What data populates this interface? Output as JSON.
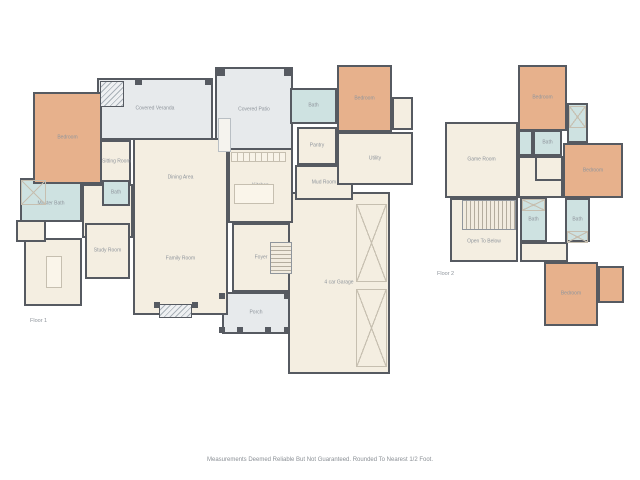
{
  "page": {
    "background": "#ffffff",
    "disclaimer": "Measurements Deemed Reliable But Not Guaranteed. Rounded To Nearest 1/2 Foot."
  },
  "palette": {
    "wall": "#565a61",
    "room_fill": "#f4eee1",
    "bedroom_fill": "#e7b18c",
    "bath_fill": "#cee2e1",
    "outdoor_fill": "#e7eaec",
    "label_text": "#8f959c",
    "fixture_line": "#c6bfb0"
  },
  "floors": [
    {
      "id": "floor-1",
      "label": "Floor 1",
      "label_pos": {
        "x": 30,
        "y": 318
      },
      "rooms": [
        {
          "name": "covered-veranda",
          "label": "Covered Veranda",
          "type": "outdoor",
          "x": 97,
          "y": 78,
          "w": 116,
          "h": 62
        },
        {
          "name": "covered-patio",
          "label": "Covered Patio",
          "type": "outdoor",
          "x": 215,
          "y": 67,
          "w": 78,
          "h": 85
        },
        {
          "name": "porch",
          "label": "Porch",
          "type": "outdoor",
          "x": 222,
          "y": 292,
          "w": 68,
          "h": 42
        },
        {
          "name": "garage",
          "label": "4 car Garage",
          "type": "room",
          "x": 288,
          "y": 192,
          "w": 102,
          "h": 182
        },
        {
          "name": "great-room",
          "type": "room",
          "x": 133,
          "y": 138,
          "w": 95,
          "h": 177,
          "labels": [
            {
              "text": "Dining Area",
              "top": 22
            },
            {
              "text": "Family Room",
              "top": 69
            }
          ]
        },
        {
          "name": "kitchen",
          "label": "Kitchen",
          "type": "room",
          "x": 228,
          "y": 148,
          "w": 65,
          "h": 75
        },
        {
          "name": "pantry",
          "label": "Pantry",
          "type": "room",
          "x": 297,
          "y": 127,
          "w": 40,
          "h": 38
        },
        {
          "name": "mud-room",
          "label": "Mud Room",
          "type": "room",
          "x": 295,
          "y": 165,
          "w": 58,
          "h": 35
        },
        {
          "name": "utility",
          "label": "Utility",
          "type": "room",
          "x": 337,
          "y": 132,
          "w": 76,
          "h": 53
        },
        {
          "name": "bedroom-closet",
          "type": "room",
          "x": 392,
          "y": 97,
          "w": 21,
          "h": 33
        },
        {
          "name": "foyer",
          "label": "Foyer",
          "type": "room",
          "x": 232,
          "y": 223,
          "w": 58,
          "h": 69
        },
        {
          "name": "hall",
          "type": "room",
          "x": 82,
          "y": 184,
          "w": 51,
          "h": 54
        },
        {
          "name": "study-room",
          "label": "Study Room",
          "type": "room",
          "x": 85,
          "y": 223,
          "w": 45,
          "h": 56
        },
        {
          "name": "hobby-room",
          "type": "room",
          "x": 24,
          "y": 238,
          "w": 58,
          "h": 68
        },
        {
          "name": "water-closet",
          "type": "room",
          "x": 16,
          "y": 220,
          "w": 30,
          "h": 22
        },
        {
          "name": "sitting-room",
          "label": "Sitting Room",
          "type": "room",
          "x": 100,
          "y": 140,
          "w": 31,
          "h": 44
        },
        {
          "name": "bath-hall",
          "label": "Bath",
          "type": "bath",
          "x": 102,
          "y": 180,
          "w": 28,
          "h": 26
        },
        {
          "name": "master-bath",
          "type": "bath",
          "x": 20,
          "y": 178,
          "w": 62,
          "h": 44,
          "labels": [
            {
              "text": "Master Bath",
              "top": 60
            }
          ]
        },
        {
          "name": "bath-guest",
          "label": "Bath",
          "type": "bath",
          "x": 290,
          "y": 88,
          "w": 47,
          "h": 36
        },
        {
          "name": "bedroom-master",
          "label": "Bedroom",
          "type": "bedroom",
          "x": 33,
          "y": 92,
          "w": 69,
          "h": 92
        },
        {
          "name": "bedroom-guest",
          "label": "Bedroom",
          "type": "bedroom",
          "x": 337,
          "y": 65,
          "w": 55,
          "h": 67
        }
      ],
      "features": [
        {
          "name": "veranda-fireplace",
          "type": "hatch",
          "x": 100,
          "y": 81,
          "w": 24,
          "h": 26
        },
        {
          "name": "veranda-post",
          "type": "post",
          "x": 135,
          "y": 78,
          "w": 7,
          "h": 7
        },
        {
          "name": "veranda-post",
          "type": "post",
          "x": 205,
          "y": 78,
          "w": 7,
          "h": 7
        },
        {
          "name": "patio-post",
          "type": "post",
          "x": 216,
          "y": 67,
          "w": 9,
          "h": 9
        },
        {
          "name": "patio-post",
          "type": "post",
          "x": 284,
          "y": 67,
          "w": 9,
          "h": 9
        },
        {
          "name": "outdoor-kitchen",
          "type": "appliance",
          "x": 218,
          "y": 118,
          "w": 13,
          "h": 34
        },
        {
          "name": "kitchen-counter",
          "type": "counter",
          "x": 231,
          "y": 152,
          "w": 55,
          "h": 10
        },
        {
          "name": "kitchen-island",
          "type": "island",
          "x": 234,
          "y": 184,
          "w": 40,
          "h": 20
        },
        {
          "name": "hobby-island",
          "type": "island",
          "x": 46,
          "y": 256,
          "w": 16,
          "h": 32
        },
        {
          "name": "master-shower",
          "type": "xbox",
          "x": 21,
          "y": 180,
          "w": 25,
          "h": 25
        },
        {
          "name": "foyer-stairs",
          "type": "stairs",
          "x": 270,
          "y": 242,
          "w": 22,
          "h": 32
        },
        {
          "name": "garage-door",
          "type": "xbox",
          "x": 356,
          "y": 204,
          "w": 31,
          "h": 78
        },
        {
          "name": "garage-door",
          "type": "xbox",
          "x": 356,
          "y": 289,
          "w": 31,
          "h": 78
        },
        {
          "name": "family-fireplace",
          "type": "hatch",
          "x": 159,
          "y": 304,
          "w": 33,
          "h": 14
        },
        {
          "name": "fireplace-post",
          "type": "post",
          "x": 154,
          "y": 302,
          "w": 6,
          "h": 6
        },
        {
          "name": "fireplace-post",
          "type": "post",
          "x": 192,
          "y": 302,
          "w": 6,
          "h": 6
        },
        {
          "name": "porch-post",
          "type": "post",
          "x": 219,
          "y": 293,
          "w": 6,
          "h": 6
        },
        {
          "name": "porch-post",
          "type": "post",
          "x": 284,
          "y": 293,
          "w": 6,
          "h": 6
        },
        {
          "name": "porch-post",
          "type": "post",
          "x": 219,
          "y": 327,
          "w": 6,
          "h": 6
        },
        {
          "name": "porch-post",
          "type": "post",
          "x": 237,
          "y": 327,
          "w": 6,
          "h": 6
        },
        {
          "name": "porch-post",
          "type": "post",
          "x": 265,
          "y": 327,
          "w": 6,
          "h": 6
        },
        {
          "name": "porch-post",
          "type": "post",
          "x": 284,
          "y": 327,
          "w": 6,
          "h": 6
        }
      ]
    },
    {
      "id": "floor-2",
      "label": "Floor 2",
      "label_pos": {
        "x": 437,
        "y": 271
      },
      "rooms": [
        {
          "name": "game-room",
          "label": "Game Room",
          "type": "room",
          "x": 445,
          "y": 122,
          "w": 73,
          "h": 76
        },
        {
          "name": "open-to-below",
          "type": "room",
          "x": 450,
          "y": 198,
          "w": 68,
          "h": 64,
          "labels": [
            {
              "text": "Open To Below",
              "top": 70
            }
          ]
        },
        {
          "name": "hall-upper",
          "type": "room",
          "x": 518,
          "y": 156,
          "w": 45,
          "h": 42
        },
        {
          "name": "linen-hall",
          "type": "room",
          "x": 535,
          "y": 156,
          "w": 28,
          "h": 25
        },
        {
          "name": "corridor",
          "type": "room",
          "x": 520,
          "y": 242,
          "w": 48,
          "h": 20
        },
        {
          "name": "toilet-cell",
          "type": "bath",
          "x": 518,
          "y": 130,
          "w": 15,
          "h": 26
        },
        {
          "name": "bath-jack",
          "label": "Bath",
          "type": "bath",
          "x": 533,
          "y": 130,
          "w": 29,
          "h": 26
        },
        {
          "name": "closet-top",
          "type": "bath",
          "x": 567,
          "y": 103,
          "w": 21,
          "h": 40
        },
        {
          "name": "bath-bottom-mid",
          "label": "Bath",
          "type": "bath",
          "x": 520,
          "y": 198,
          "w": 27,
          "h": 44
        },
        {
          "name": "bath-bottom-right",
          "label": "Bath",
          "type": "bath",
          "x": 565,
          "y": 198,
          "w": 25,
          "h": 44
        },
        {
          "name": "bedroom-2",
          "label": "Bedroom",
          "type": "bedroom",
          "x": 518,
          "y": 65,
          "w": 49,
          "h": 66
        },
        {
          "name": "bedroom-3",
          "label": "Bedroom",
          "type": "bedroom",
          "x": 563,
          "y": 143,
          "w": 60,
          "h": 55
        },
        {
          "name": "bedroom-4",
          "label": "Bedroom",
          "type": "bedroom",
          "x": 544,
          "y": 262,
          "w": 54,
          "h": 64
        },
        {
          "name": "bedroom-4-nook",
          "type": "bedroom",
          "x": 598,
          "y": 266,
          "w": 26,
          "h": 37
        }
      ],
      "features": [
        {
          "name": "upper-stairs",
          "type": "stairs-h",
          "x": 462,
          "y": 200,
          "w": 54,
          "h": 30
        },
        {
          "name": "closet-x",
          "type": "xbox",
          "x": 569,
          "y": 106,
          "w": 17,
          "h": 22
        },
        {
          "name": "closet-x",
          "type": "xbox",
          "x": 522,
          "y": 199,
          "w": 23,
          "h": 12
        },
        {
          "name": "closet-x",
          "type": "xbox",
          "x": 567,
          "y": 231,
          "w": 21,
          "h": 12
        }
      ]
    }
  ]
}
